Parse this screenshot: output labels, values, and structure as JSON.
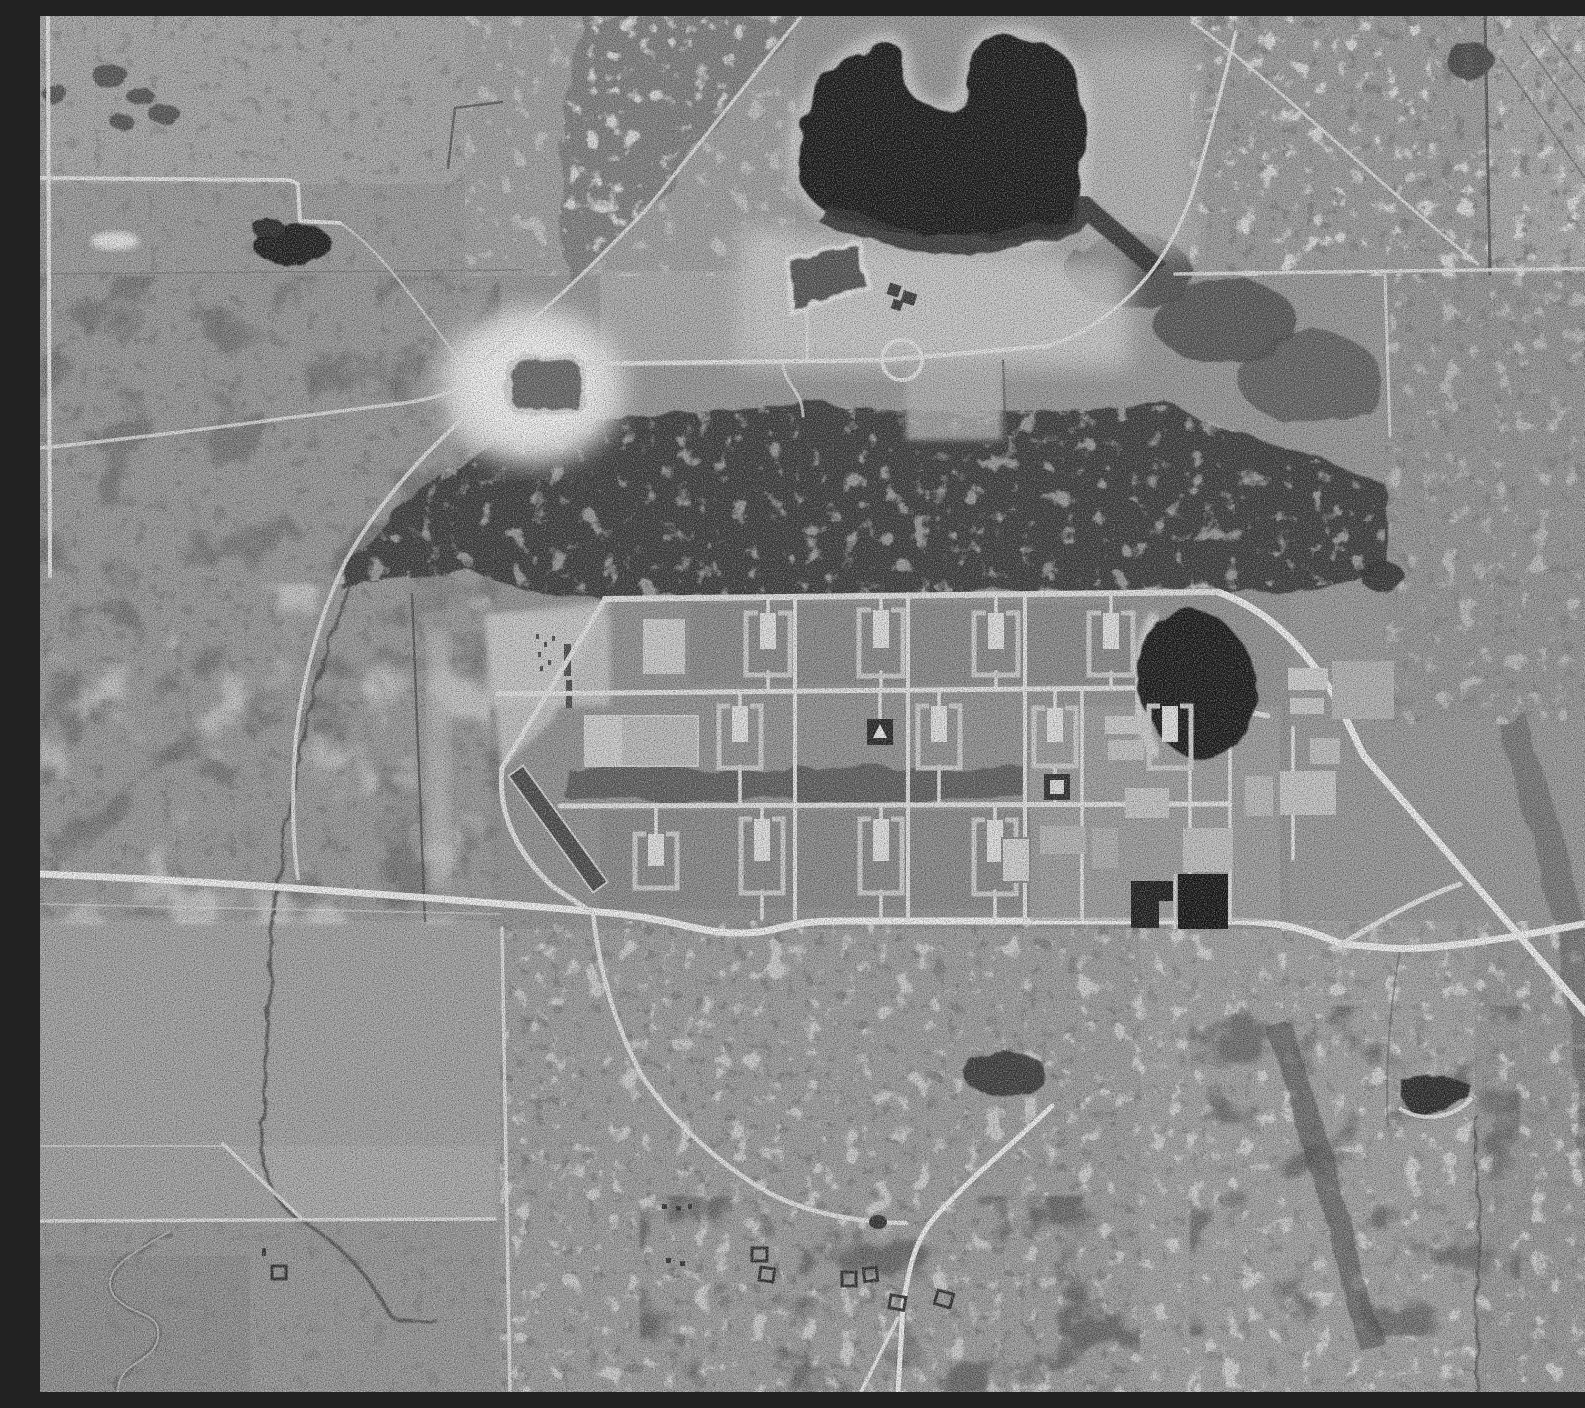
{
  "meta": {
    "title": "Monochrome vertical aerial photograph",
    "image_kind": "black-and-white aerial reconnaissance photograph",
    "description": "Vertical black-and-white aerial photograph of rural terrain. A large industrial facility with a grid of light service roads and rows of U-shaped revetment buildings occupies the center. A large irregular dark lake lies top center, a dark oval pond sits at the facility's northeast corner, and two black settling basins lie at its southeast. Bright sandy clearings, a rectangular borrow pond, farm fields, scrub woodland, meandering creeks, a diagonal highway and a small scatter of structures to the south complete the scene. No text appears in the image."
  },
  "palette": {
    "base": "#9a9a9a",
    "field_light": "#a9a9a9",
    "field_bright": "#c6c6c6",
    "sand": "#d9d9d9",
    "road": "#e7e7e7",
    "road_bright": "#f5f5f5",
    "fence": "#4f4f4f",
    "water_dark": "#121212",
    "pond_mid": "#565656",
    "pond_rect": "#6a6a6a",
    "forest": "#3e3e3e",
    "scrub": "#6e6e6e",
    "building": "#d0d0d0",
    "building_bright": "#e6e6e6",
    "basin": "#111111",
    "marker_dark": "#262626"
  },
  "regions": {
    "photo": "monochrome vertical aerial photograph of rural terrain with central industrial facility",
    "large_lake": "large irregular dark lake with notched northern shore and wooded southern fringe",
    "lake_sand": "bright sandy flats south and west of the large lake",
    "trapezoid_pond": "trapezoidal pond with bright embankment below the lake",
    "borrow_pond": "rounded rectangular pond inside a bright white sandy clearing",
    "forest_band": "broad dark band of woodland north of the facility",
    "nw_lake_forest": "mottled woodland northwest of the lake",
    "ne_woodland": "mottled woodland and fields in the northeast quadrant",
    "facility": "industrial facility with gridded light roads and rows of rectangular revetment buildings",
    "facility_pond": "dark oval pond at the facility northeast corner",
    "settling_basins": "two black rectangular settling basins at the facility southeast",
    "west_apron": "bright entrance apron with small dark objects at the facility west side",
    "dark_strip": "dark elongated diagonal strip with light edges at the facility southwest",
    "main_road": "east-west main road crossing the full image south of the facility",
    "diagonal_highway": "light highway running diagonally southeast from the facility pond",
    "north_road": "east-west road between lake flats and facility",
    "nw_fields": "rectangular farm fields with light boundary roads, northwest quadrant",
    "sw_fields": "farm fields, boundary lines and meandering creek, southwest quadrant",
    "creek": "dark meandering creek flowing south across the western fields",
    "settlement": "scattered small square structures along a southern track",
    "settlement_road": "bright track descending to the southern settlement",
    "se_scrub": "mottled scrub with dark drainage lines, southeast quadrant",
    "small_pond_se": "small dark pond with bright crescent shore, lower right",
    "tree_clump_nw": "dark clump of trees in the northwest fields"
  },
  "counts": {
    "u_shaped_revetment_buildings": 12,
    "solid_buildings": 2,
    "settling_basins": 2,
    "ponds": 5,
    "settlement_structures": 7
  }
}
